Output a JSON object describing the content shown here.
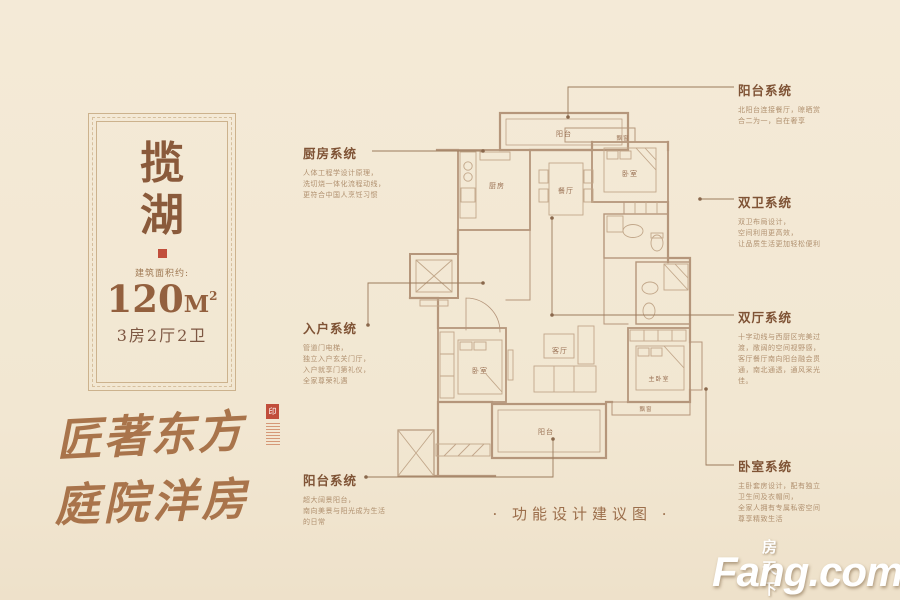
{
  "colors": {
    "background": "#f2e7d3",
    "plan_line": "#b5967b",
    "leader_line": "#9b7b5c",
    "title_text": "#7f5335",
    "body_text": "#b0906f",
    "name_text": "#8a5a3b",
    "seal_red": "#c14e3b",
    "calligraphy": "#a9744b",
    "watermark": "#ffffff"
  },
  "badge": {
    "char1": "揽",
    "char2": "湖",
    "area_label": "建筑面积约:",
    "area_value": "120",
    "area_unit": "M",
    "area_sup": "2",
    "layout": "3房2厅2卫"
  },
  "slogan": {
    "line1": "匠著东方",
    "line2": "庭院洋房",
    "seal": "印"
  },
  "annotations": {
    "left": [
      {
        "id": "kitchen-system",
        "title": "厨房系统",
        "lines": [
          "人体工程学设计原理，",
          "洗切烧一体化流程动线，",
          "更符合中国人烹饪习惯"
        ]
      },
      {
        "id": "entry-system",
        "title": "入户系统",
        "lines": [
          "管道门电梯，",
          "独立入户玄关门厅，",
          "入户就享门第礼仪，",
          "全家尊荣礼遇"
        ]
      },
      {
        "id": "balcony-system-left",
        "title": "阳台系统",
        "lines": [
          "超大阔景阳台，",
          "南向美景与阳光成为生活",
          "的日常"
        ]
      }
    ],
    "right": [
      {
        "id": "balcony-system-right",
        "title": "阳台系统",
        "lines": [
          "北阳台连接餐厅，晾晒赏",
          "合二为一，自在奢享"
        ]
      },
      {
        "id": "bath-system",
        "title": "双卫系统",
        "lines": [
          "双卫布局设计，",
          "空间利用更高效，",
          "让品质生活更加轻松便利"
        ]
      },
      {
        "id": "hall-system",
        "title": "双厅系统",
        "lines": [
          "十字动线与西厨区完美过",
          "渡，敞阔的空间视野感，",
          "客厅餐厅南向阳台融会贯",
          "通，南北通透，通风采光",
          "佳。"
        ]
      },
      {
        "id": "bedroom-system",
        "title": "卧室系统",
        "lines": [
          "主卧套房设计，配有独立",
          "卫生间及衣帽间，",
          "全家人拥有专属私密空间",
          "尊享精致生活"
        ]
      }
    ]
  },
  "plan": {
    "rooms": {
      "balcony_top": "阳台",
      "kitchen": "厨房",
      "dining": "餐厅",
      "bedroom_top": "卧室",
      "bay_top": "飘窗",
      "living": "客厅",
      "bedroom_left": "卧室",
      "master_bedroom": "主卧室",
      "bay_bottom": "飘窗",
      "balcony_bottom": "阳台"
    }
  },
  "caption": {
    "text": "· 功能设计建议图 ·"
  },
  "watermark": {
    "cn": "房天下",
    "en": "Fang.com"
  }
}
